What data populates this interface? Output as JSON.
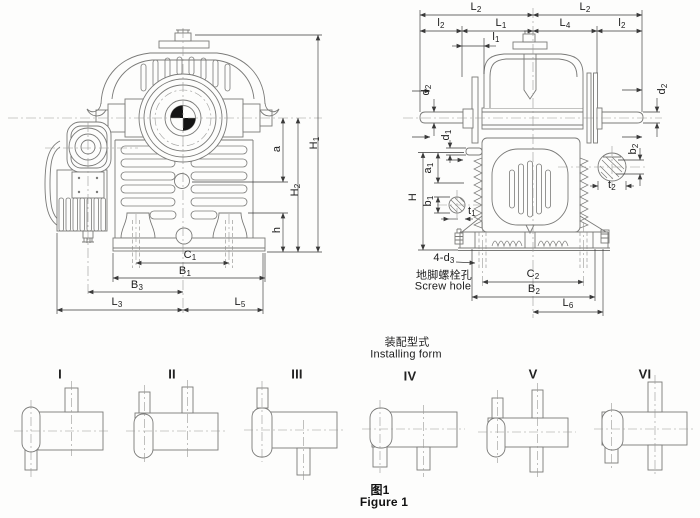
{
  "figure": {
    "caption_zh": "图1",
    "caption_en": "Figure 1"
  },
  "front_view": {
    "dims": {
      "a": {
        "base": "a",
        "sub": ""
      },
      "H1": {
        "base": "H",
        "sub": "1"
      },
      "H2": {
        "base": "H",
        "sub": "2"
      },
      "h": {
        "base": "h",
        "sub": ""
      },
      "C1": {
        "base": "C",
        "sub": "1"
      },
      "B1": {
        "base": "B",
        "sub": "1"
      },
      "B3": {
        "base": "B",
        "sub": "3"
      },
      "L3": {
        "base": "L",
        "sub": "3"
      },
      "L5": {
        "base": "L",
        "sub": "5"
      }
    }
  },
  "side_view": {
    "dims": {
      "L2": {
        "base": "L",
        "sub": "2"
      },
      "l2": {
        "base": "l",
        "sub": "2"
      },
      "L1": {
        "base": "L",
        "sub": "1"
      },
      "L4": {
        "base": "L",
        "sub": "4"
      },
      "l1": {
        "base": "l",
        "sub": "1"
      },
      "d2": {
        "base": "d",
        "sub": "2"
      },
      "d1": {
        "base": "d",
        "sub": "1"
      },
      "a1": {
        "base": "a",
        "sub": "1"
      },
      "b1": {
        "base": "b",
        "sub": "1"
      },
      "H": {
        "base": "H",
        "sub": ""
      },
      "t1": {
        "base": "t",
        "sub": "1"
      },
      "b2": {
        "base": "b",
        "sub": "2"
      },
      "t2": {
        "base": "t",
        "sub": "2"
      },
      "C2": {
        "base": "C",
        "sub": "2"
      },
      "B2": {
        "base": "B",
        "sub": "2"
      },
      "L6": {
        "base": "L",
        "sub": "6"
      },
      "d3": {
        "base": "4-d",
        "sub": "3"
      }
    },
    "screw_hole_note": {
      "zh": "地脚螺栓孔",
      "en": "Screw hole"
    }
  },
  "installing": {
    "title_zh": "装配型式",
    "title_en": "Installing form",
    "forms": [
      {
        "label": "I"
      },
      {
        "label": "II"
      },
      {
        "label": "III"
      },
      {
        "label": "IV"
      },
      {
        "label": "V"
      },
      {
        "label": "VI"
      }
    ]
  }
}
